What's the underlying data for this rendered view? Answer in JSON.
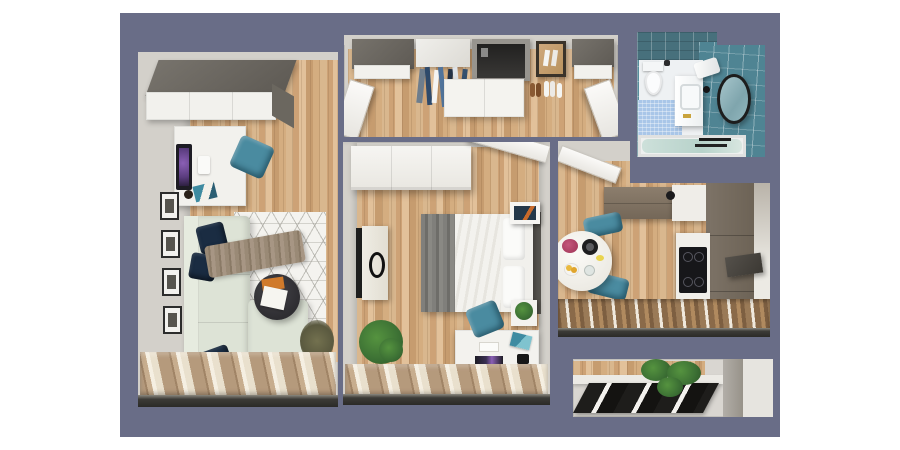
{
  "scene": {
    "type": "3d-apartment-floor-plan-render",
    "page_background": "#ffffff",
    "board_background": "#696d87",
    "room_count": 6
  },
  "palette": {
    "wall_gray": "#d3d0ca",
    "wood_floor_light": "#e2c19a",
    "wood_floor_dark": "#c69c6f",
    "cabinet_dark_top": "#5e5a54",
    "cabinet_white": "#f2f1ed",
    "cabinet_taupe": "#8c7e6d",
    "sofa_sage": "#dde3d6",
    "pillow_navy": "#1a2c42",
    "throw_taupe": "#9a8a76",
    "chair_teal": "#4a8ba0",
    "rug_white": "#f4f3ef",
    "coffee_table_black": "#38373b",
    "monitor_screen_purple": "#6d4b93",
    "curtain_tan": "#b59a7c",
    "curtain_cream": "#f5efe2",
    "window_sill_dark": "#2b2a27",
    "bathroom_tile_teal": "#568e9d",
    "bath_mat_blue": "#a9c6e8",
    "tub_water_green": "#cde0da",
    "plant_green": "#3c7034",
    "bed_linen_white": "#f1f0ec",
    "bed_throw_gray": "#7d7c78",
    "cooktop_black": "#17171a",
    "accent_orange": "#d07a2b",
    "flower_pink": "#c4577c",
    "fruit_yellow": "#e9b93e"
  },
  "rooms": [
    {
      "id": "living-room",
      "items": [
        "wardrobe",
        "desk",
        "monitor",
        "keyboard",
        "teal-chair",
        "gallery-frames-x4",
        "corner-sofa",
        "navy-pillows-x3",
        "throw-blanket",
        "geometric-rug",
        "coffee-table",
        "magazine",
        "dried-plant",
        "curtains",
        "window-sill"
      ]
    },
    {
      "id": "hallway",
      "items": [
        "dark-wardrobe-left",
        "white-cabinet",
        "hanging-clothes",
        "entrance-door-recess",
        "mirror",
        "shoes",
        "sideboard",
        "dark-wardrobe-right",
        "open-door-left",
        "open-door-right"
      ]
    },
    {
      "id": "bedroom",
      "items": [
        "wardrobe",
        "open-door",
        "double-bed",
        "gray-throw",
        "pillows",
        "headboard",
        "wall-art",
        "tv",
        "dresser",
        "nightstand-plant",
        "desk",
        "monitor",
        "art-prints",
        "teal-chair",
        "potted-plant",
        "curtains",
        "window-sill"
      ]
    },
    {
      "id": "kitchen",
      "items": [
        "open-door",
        "upper-cabinets",
        "faucet",
        "counter",
        "tall-cabinets",
        "induction-cooktop",
        "extractor-accent",
        "round-dining-table",
        "flower-bouquet",
        "black-plate",
        "fruit-plate",
        "teal-chairs-x2",
        "wood-blinds",
        "window-sill"
      ]
    },
    {
      "id": "bathroom",
      "items": [
        "teal-tile-walls",
        "toilet",
        "bath-mat",
        "vanity-sink",
        "faucet",
        "round-mirror",
        "towel",
        "bathtub",
        "towel-rack"
      ]
    },
    {
      "id": "balcony",
      "items": [
        "wood-floor-strip",
        "white-parapet",
        "dark-window-frames",
        "plants",
        "concrete-pillar"
      ]
    }
  ]
}
